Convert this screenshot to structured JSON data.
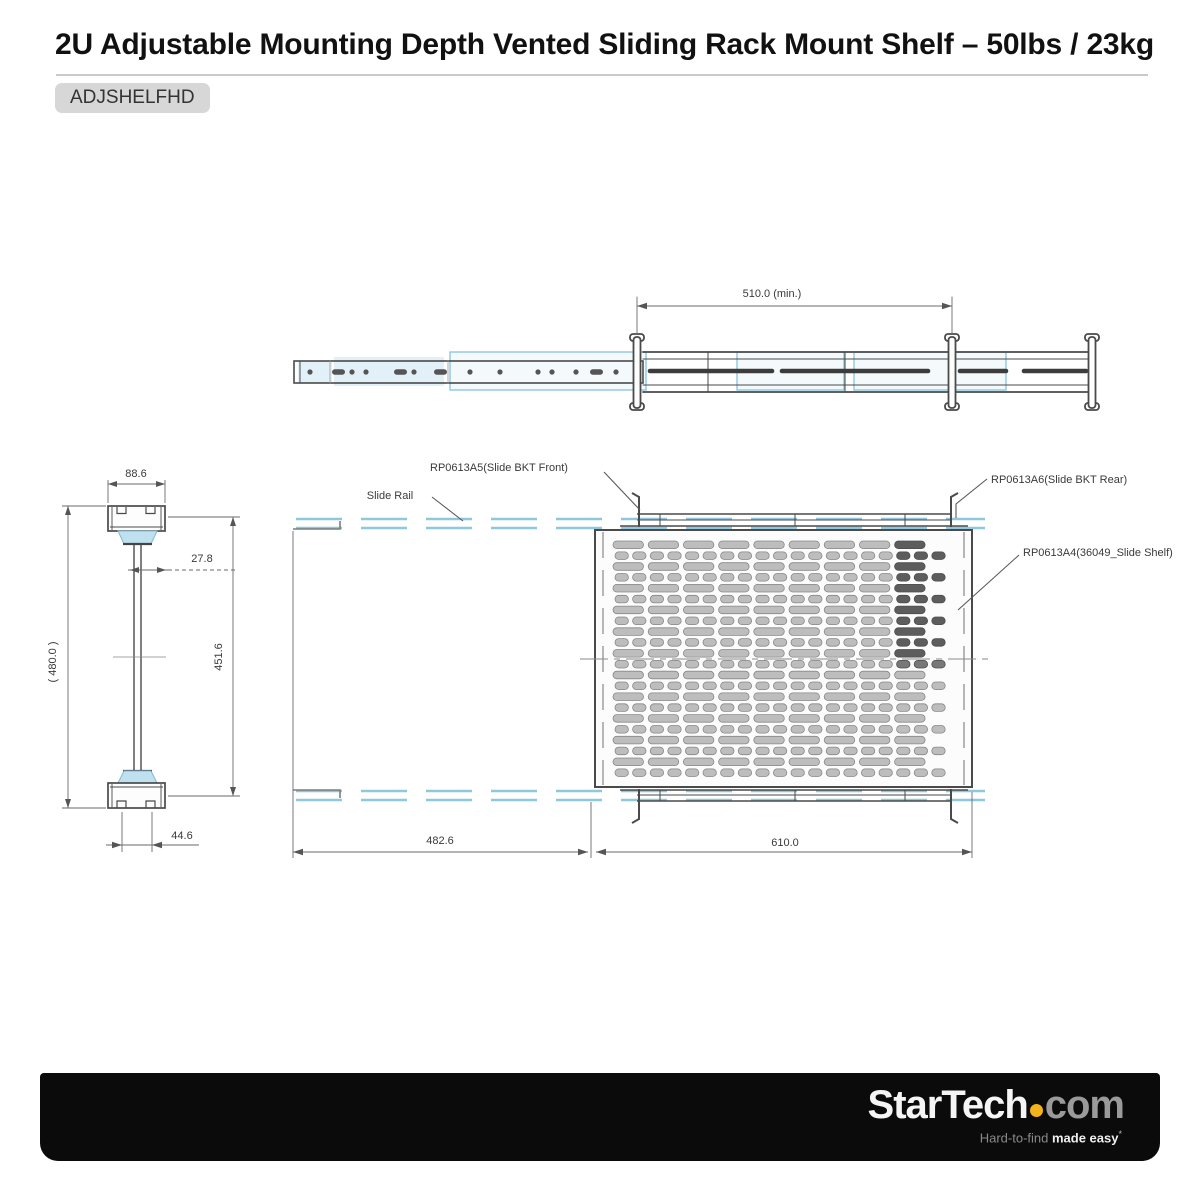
{
  "header": {
    "title": "2U Adjustable Mounting Depth Vented Sliding Rack Mount Shelf – 50lbs / 23kg",
    "sku": "ADJSHELFHD"
  },
  "drawing": {
    "labels": {
      "slide_rail": "Slide Rail",
      "bkt_front": "RP0613A5(Slide BKT Front)",
      "bkt_rear": "RP0613A6(Slide BKT Rear)",
      "shelf": "RP0613A4(36049_Slide Shelf)"
    },
    "dims": {
      "rail_min": "510.0 (min.)",
      "front_width": "88.6",
      "stem_offset": "27.8",
      "overall_height": "( 480.0 )",
      "inner_height": "451.6",
      "foot_width": "44.6",
      "rail_length": "482.6",
      "shelf_width": "610.0"
    },
    "colors": {
      "highlight": "#8ec7de",
      "highlight_fill": "rgba(150,205,228,0.28)",
      "line": "#4a4a4a",
      "dim_line": "#6a6a6a",
      "slot_fill": "#bdbdbd",
      "slot_stroke": "#878787",
      "slot_dark_fill": "#787878",
      "slot_dark_stroke": "#4d4d4d",
      "slot_core_fill": "#5d5d5d"
    }
  },
  "footer": {
    "brand": "StarTech",
    "domain": "com",
    "dot_color": "#f2b31b",
    "tagline_light": "Hard-to-find",
    "tagline_bold": "made easy",
    "tagline_mark": "*"
  }
}
